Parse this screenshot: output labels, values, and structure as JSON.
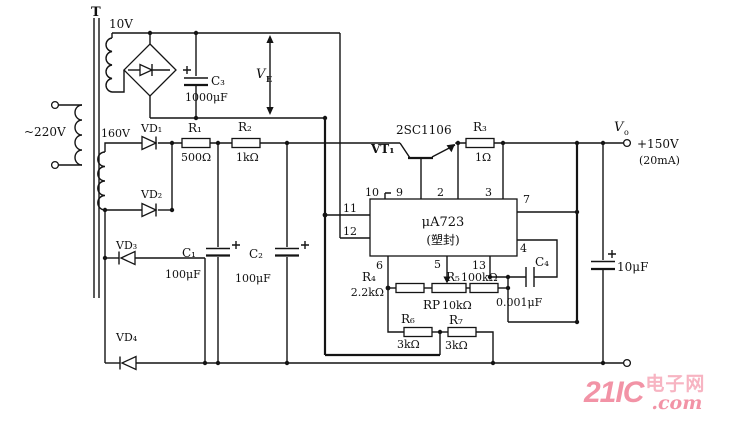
{
  "transformer": {
    "core_label": "T",
    "primary": "~220V",
    "winding_top": "10V",
    "winding_hv": "160V"
  },
  "diodes": {
    "vd1": "VD₁",
    "vd2": "VD₂",
    "vd3": "VD₃",
    "vd4": "VD₄"
  },
  "resistors": {
    "r1": "R₁",
    "r1v": "500Ω",
    "r2": "R₂",
    "r2v": "1kΩ",
    "r3": "R₃",
    "r3v": "1Ω",
    "r4": "R₄",
    "r4v": "2.2kΩ",
    "r5": "R₅",
    "r5v": "100kΩ",
    "r6": "R₆",
    "r6v": "3kΩ",
    "r7": "R₇",
    "r7v": "3kΩ",
    "rp": "RP",
    "rpv": "10kΩ"
  },
  "capacitors": {
    "c1": "C₁",
    "c1v": "100μF",
    "c2": "C₂",
    "c2v": "100μF",
    "c3": "C₃",
    "c3v": "1000μF",
    "c4": "C₄",
    "c4v": "0.001μF",
    "cout": "10μF"
  },
  "transistor": {
    "ref": "VT₁",
    "part": "2SC1106"
  },
  "ic": {
    "name": "μA723",
    "package": "(塑封)",
    "pins": {
      "p2": "2",
      "p3": "3",
      "p4": "4",
      "p5": "5",
      "p6": "6",
      "p7": "7",
      "p9": "9",
      "p10": "10",
      "p11": "11",
      "p12": "12",
      "p13": "13"
    }
  },
  "nodes": {
    "ve_sym": "V",
    "ve_sub": "E",
    "vo_sym": "V",
    "vo_sub": "o",
    "vout": "+150V",
    "iout": "(20mA)"
  },
  "watermark": {
    "brand": "21IC",
    "site": "电子网",
    "tld": ".com"
  }
}
